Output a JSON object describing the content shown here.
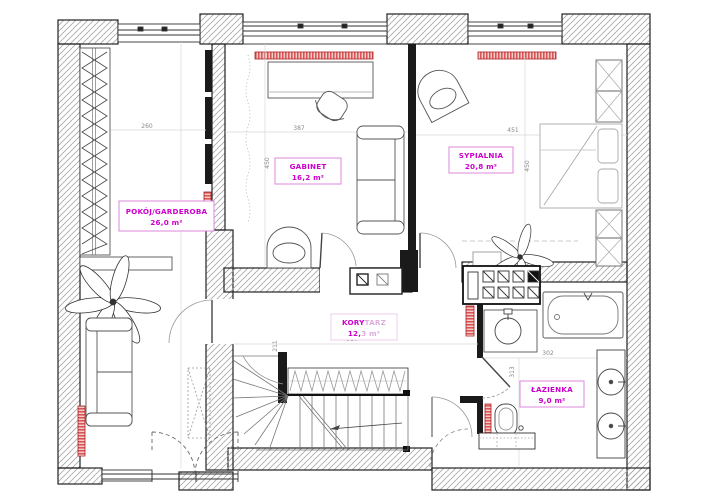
{
  "plan": {
    "type": "apartment-floor-plan",
    "rooms": {
      "pokoj": {
        "name": "POKÓJ/GARDEROBA",
        "area": "26,0 m²"
      },
      "gabinet": {
        "name": "GABINET",
        "area": "16,2 m²"
      },
      "sypialnia": {
        "name": "SYPIALNIA",
        "area": "20,8 m²"
      },
      "korytarz": {
        "name": "KORYTARZ",
        "area": "12,3 m²",
        "name_a": "KORY",
        "name_b": "TARZ",
        "area_a": "12,",
        "area_b": "3 m²"
      },
      "lazienka": {
        "name": "ŁAZIENKA",
        "area": "9,0 m²"
      }
    },
    "dimensions": [
      {
        "value": "260",
        "room": "pokoj",
        "orientation": "horizontal"
      },
      {
        "value": "387",
        "room": "gabinet",
        "orientation": "horizontal"
      },
      {
        "value": "450",
        "room": "gabinet",
        "orientation": "vertical"
      },
      {
        "value": "451",
        "room": "sypialnia",
        "orientation": "horizontal"
      },
      {
        "value": "450",
        "room": "sypialnia",
        "orientation": "vertical"
      },
      {
        "value": "510",
        "room": "korytarz",
        "orientation": "horizontal"
      },
      {
        "value": "211",
        "room": "korytarz",
        "orientation": "vertical"
      },
      {
        "value": "302",
        "room": "lazienka",
        "orientation": "horizontal"
      },
      {
        "value": "313",
        "room": "lazienka",
        "orientation": "vertical"
      }
    ],
    "colors": {
      "room_label": "#cc00cc",
      "room_label_faded": "#ddaedd",
      "label_box_border": "#dd88dd",
      "radiator": "#cc4040",
      "dimension_text": "#8a8a8a",
      "wall_hatch": "#a8a8a8",
      "interior_wall": "#1a1a1a"
    }
  }
}
